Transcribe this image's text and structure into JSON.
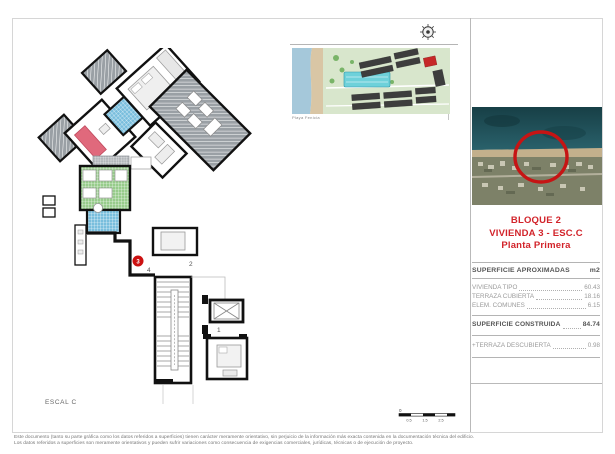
{
  "sheet": {
    "escal_label": "ESCAL C"
  },
  "site_plan": {
    "caption": "Playa Fenicia"
  },
  "title_block": {
    "line1": "BLOQUE 2",
    "line2": "VIVIENDA 3 - ESC.C",
    "line3": "Planta Primera",
    "accent_color": "#d2232a"
  },
  "area_table": {
    "header": "SUPERFICIE APROXIMADAS",
    "unit": "m2",
    "rows": [
      {
        "label": "VIVIENDA TIPO",
        "value": "60.43"
      },
      {
        "label": "TERRAZA CUBIERTA",
        "value": "18.16"
      },
      {
        "label": "ELEM. COMUNES",
        "value": "6.15"
      }
    ],
    "total_label": "SUPERFICIE CONSTRUIDA",
    "total_value": "84.74",
    "extra_label": "+TERRAZA DESCUBIERTA",
    "extra_value": "0.98"
  },
  "floor_plan": {
    "marker": "3",
    "unit_labels": {
      "u1": "1",
      "u2": "2",
      "u4": "4"
    },
    "highlight_color": "#cc1111"
  },
  "scale_bar": {
    "zero": "0",
    "labels": [
      "0.5",
      "1.5",
      "2.5"
    ]
  },
  "footer": {
    "line1": "Este documento (tanto su parte gráfica como los datos referidos a superficies) tienen carácter meramente orientativo, sin perjuicio de la información más exacta contenida en la documentación técnica del edificio.",
    "line2": "Los datos referidos a superficies son meramente orientativos y pueden sufrir variaciones como consecuencia de exigencias comerciales, jurídicas, técnicas o de ejecución de proyecto."
  },
  "colors": {
    "sea": "#1c4a52",
    "beach": "#c3b08c",
    "land": "#7d8168",
    "tile_blue": "#79bedd",
    "tile_green": "#97cc8b",
    "hatch_gray": "#9aa0a5"
  }
}
